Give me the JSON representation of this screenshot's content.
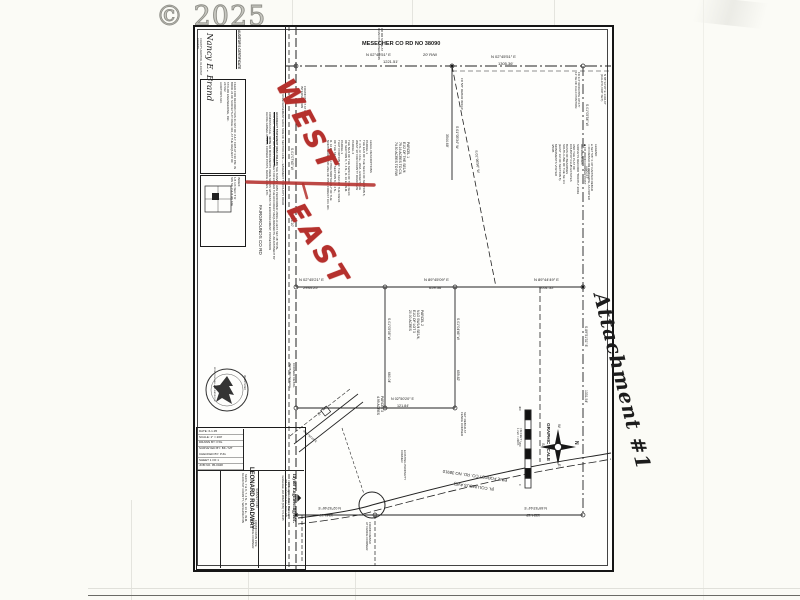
{
  "watermark": "© 2025",
  "attachment_note": "Attachment #1",
  "ink_color": "#1b1b1b",
  "red_annotations": {
    "word_top": "WEST",
    "word_bottom": "EAST",
    "color": "#b5312d"
  },
  "certificates": {
    "auditor_heading": "AUDITOR'S CERTIFICATE",
    "auditor_signature": "Nancy E. Brand",
    "auditor_signer_title": "COUNTY AUDITOR, KLICKITAT COUNTY",
    "auditor_filing": "FILED FOR RECORD THIS 21 DAY OF JULY, 1995 AT 3:30 P.M. IN BOOK 24 OF SURVEYS AT PAGE 392, AT THE REQUEST OF TAYLOR ENGINEERING, INC.\n247332\nAUDITOR'S NO.",
    "easement_note": "30' ROAD EASEMENT EACH SIDE OF SECTION LINE — EASEMENT TO COUNTY ROAD"
  },
  "index_box": {
    "text": "INDEX\n1/4 1/4   SEC    T     R\nSW SE   7 & 8   4N   16E"
  },
  "accuracy": {
    "heading": "ACCURACY STATEMENT (WAC 332-130)",
    "body": "THE SURVEY WAS PERFORMED USING A LIETZ SET-4B TOTAL STATION. TRAVERSE METHODS USED MEET OR EXCEED THE ACCURACY REQUIREMENTS. ADJUSTMENT BY COMPASS RULE.",
    "note_heading": "NOTE",
    "note": "NO MONUMENTS WERE SET AS WITNESS TO ENCROACHMENT; POSSESSION ALONG GRAVEL ROADS, CORNER POSTS, FENCE LINES, ETC."
  },
  "legal": {
    "text": "LEGAL DESCRIPTIONS\nPARCEL 1\nTHE E1/2 OF THE SE1/4 OF SECTION 8,\nT. 4 N., R. 16 E., W.M., EXCEPT THE\nWEST 30' FOR COUNTY ROAD R/W\nPARCEL 2\nTHE N1/2 OF THE SW1/4 OF THE SE1/4\nOF SECTION 8, T. 4 N., R. 16 E., W.M.\nPARCEL 3\nTHAT PORTION OF THE S1/2 OF THE SW1/4\nOF THE SE1/4 OF SECTION 8, T. 4 N.,\nR. 16 E., W.M., LYING NORTHERLY OF THE\nNORTHERLY R/W LINE OF PINE FOREST CO. RD."
  },
  "legend": {
    "text": "LEGEND\n● SET 5/8″ X 30″ CAPPED REBAR\n○ FD REBAR OR IRON PIPE, AS NOTED\n◆ FD WOOD CORNER POST\nREFERENCES\nSURVEYS RECORD \"BOOTH\" 2/049\nAND THE PLAT OF\nCOUNTRY CLUB ESTATES\nBASIS OF BEARINGS\nSOUTH LINE OF THE SE 1/4\n(EAST 1/2 OF SECTION 8)\nMONUMENTS VISITED\n4/5/95"
  },
  "parcels": {
    "p1": "PARCEL 1\nE1/2 OF THE SE1/4\n79.16 ACRES TO C/L\n74.50 ACRES TO R/W",
    "p2": "PARCEL 2\nN1/2 SW1/4 SE1/4,\nE1/2 OF LOT 3\n20.00 ACRES",
    "p3": "PARCEL 3\n4.99 ACRES"
  },
  "corner_detail": {
    "label": "CORNER DETAIL\n(NOT TO SCALE)"
  },
  "scale_bar": {
    "title": "GRAPHIC SCALE",
    "sub": "( IN FEET )\n1 inch = 200 ft."
  },
  "title_block": {
    "fields": [
      "DATE: 6-1-95",
      "SCALE: 1″ = 200′",
      "DRAWN BY: PJG",
      "SURVEYED BY: BK / MT",
      "CHECKED BY: PJG",
      "SHEET 1 OF 1",
      "JOB NO. 95-0048"
    ],
    "survey_for": "SURVEY FOR",
    "client": "LEONARD ROADWAY",
    "location": "SECS. 7 & 8, T. 4 N., R. 16 E., W.M.",
    "county": "KLICKITAT COUNTY, WASHINGTON",
    "firm": "Taylor Engineering, Inc.",
    "firm_tagline": "Civil Design and Land Planning",
    "firm_address": "205 S. Columbus Ave., Suite 200\nGoldendale, WA 98620   (509) 773-4945"
  },
  "map_labels": [
    {
      "t": "MESECHER CO RD NO 38090",
      "x": 362,
      "y": 41,
      "fs": 5.6,
      "b": true,
      "n": "road-name-top"
    },
    {
      "t": "N 02°45′51″ E",
      "x": 366,
      "y": 53,
      "fs": 4
    },
    {
      "t": "20′ R/W",
      "x": 423,
      "y": 53,
      "fs": 4
    },
    {
      "t": "1221.51′",
      "x": 383,
      "y": 60,
      "fs": 4
    },
    {
      "t": "N 02°45′51″ E",
      "x": 491,
      "y": 55,
      "fs": 4
    },
    {
      "t": "1305.36′",
      "x": 498,
      "y": 62,
      "fs": 4
    },
    {
      "t": "FOUND BOLT AT ROAD\nINTERSECTION",
      "x": 306,
      "y": 86,
      "r": 90,
      "fs": 3
    },
    {
      "t": "FD RR SPIKE AT\nROAD INTERSECTION",
      "x": 383,
      "y": 28,
      "r": 90,
      "fs": 3
    },
    {
      "t": "FD 3/4″ IRON PIPE UP 0.5′\n12′ SE OF CALC POSITION",
      "x": 580,
      "y": 72,
      "r": 90,
      "fs": 2.9
    },
    {
      "t": "N 88°12′18″ E 1304.67′\n(CALC'D, NOT SET)",
      "x": 606,
      "y": 74,
      "r": 90,
      "fs": 3
    },
    {
      "t": "FD 5/8″ REBAR W/CAP",
      "x": 463,
      "y": 78,
      "r": 90,
      "fs": 3
    },
    {
      "t": "S 01°05′34″ W",
      "x": 459,
      "y": 126,
      "r": 90,
      "fs": 3.5
    },
    {
      "t": "3544.68′",
      "x": 449,
      "y": 134,
      "r": 90,
      "fs": 3.5
    },
    {
      "t": "S 01°06′56″ W",
      "x": 478,
      "y": 150,
      "r": 84,
      "fs": 3.5
    },
    {
      "t": "FAIRGROUNDS CO RD",
      "x": 263,
      "y": 205,
      "r": 90,
      "fs": 4.6,
      "n": "road-name-left"
    },
    {
      "t": "S 01°07′43″ W",
      "x": 293,
      "y": 148,
      "r": 90,
      "fs": 3.4
    },
    {
      "t": "1324.10′",
      "x": 293,
      "y": 214,
      "r": 90,
      "fs": 3.4
    },
    {
      "t": "N 02°45′21″ E",
      "x": 299,
      "y": 278,
      "fs": 4
    },
    {
      "t": "2934.25′",
      "x": 303,
      "y": 285.5,
      "fs": 4
    },
    {
      "t": "N 89°45′09″ E",
      "x": 424,
      "y": 278,
      "fs": 4
    },
    {
      "t": "659.36′",
      "x": 429,
      "y": 285.5,
      "fs": 4
    },
    {
      "t": "N 89°44′49″ E",
      "x": 534,
      "y": 278,
      "fs": 4
    },
    {
      "t": "1051.52′",
      "x": 539,
      "y": 285.5,
      "fs": 4
    },
    {
      "t": "S 01°05′54″ W",
      "x": 588,
      "y": 104,
      "r": 90,
      "fs": 3.4
    },
    {
      "t": "1320.57′",
      "x": 588,
      "y": 166,
      "r": 90,
      "fs": 3.4
    },
    {
      "t": "S 89°51′31″ E",
      "x": 587,
      "y": 326,
      "r": 90,
      "fs": 3.4
    },
    {
      "t": "1331.54′",
      "x": 587,
      "y": 390,
      "r": 90,
      "fs": 3.4
    },
    {
      "t": "S 01°05′08″ W",
      "x": 390,
      "y": 318,
      "r": 90,
      "fs": 3.4
    },
    {
      "t": "660.04′",
      "x": 390,
      "y": 372,
      "r": 90,
      "fs": 3.4
    },
    {
      "t": "S 01°04′46″ W",
      "x": 459,
      "y": 318,
      "r": 90,
      "fs": 3.4
    },
    {
      "t": "659.82′",
      "x": 459,
      "y": 370,
      "r": 90,
      "fs": 3.4
    },
    {
      "t": "N 02°50′20″ E",
      "x": 391,
      "y": 397,
      "fs": 3.7
    },
    {
      "t": "121.84′",
      "x": 397,
      "y": 403.5,
      "fs": 3.7
    },
    {
      "t": "SET REBAR AT\nFENCE CORNER",
      "x": 466,
      "y": 412,
      "r": 90,
      "fs": 3
    },
    {
      "t": "EXISTING PROPERTY\nCORNER",
      "x": 406,
      "y": 450,
      "r": 90,
      "fs": 2.9
    },
    {
      "t": "N 02°52′46″ E",
      "x": 341,
      "y": 510,
      "r": 180,
      "fs": 3.7
    },
    {
      "t": "1341.19′",
      "x": 333,
      "y": 517,
      "r": 180,
      "fs": 3.7
    },
    {
      "t": "N 89°53′44″ E",
      "x": 547,
      "y": 510,
      "r": 180,
      "fs": 3.7
    },
    {
      "t": "1324.12′",
      "x": 540,
      "y": 517,
      "r": 180,
      "fs": 3.7
    },
    {
      "t": "PINE FOREST CO. RD. NO 38910",
      "x": 507,
      "y": 482,
      "r": 188,
      "fs": 4.2,
      "n": "road-name-bottom"
    },
    {
      "t": "(N. COLUMBUS AVE)",
      "x": 494,
      "y": 491,
      "r": 188,
      "fs": 4.2,
      "n": "road-name-bottom-alt"
    },
    {
      "t": "FOUND IRON PIPE\nAT FENCE CORNER",
      "x": 257,
      "y": 520,
      "r": 90,
      "fs": 3
    },
    {
      "t": "FOUND REBAR\nAT FENCE CORNER",
      "x": 371,
      "y": 522,
      "r": 90,
      "fs": 3
    },
    {
      "t": "30′",
      "x": 318,
      "y": 412,
      "r": 40,
      "fs": 3
    },
    {
      "t": "N 02°50′20″ E",
      "x": 304,
      "y": 430,
      "r": 40,
      "fs": 2.8
    },
    {
      "t": "N",
      "x": 578,
      "y": 441,
      "r": 90,
      "fs": 5,
      "b": true,
      "n": "compass-n"
    },
    {
      "t": "W",
      "x": 561,
      "y": 424,
      "r": 90,
      "fs": 4,
      "n": "compass-w"
    },
    {
      "t": "S",
      "x": 545,
      "y": 443,
      "r": 90,
      "fs": 4,
      "n": "compass-s"
    },
    {
      "t": "E",
      "x": 561,
      "y": 464,
      "r": 90,
      "fs": 4,
      "n": "compass-e"
    },
    {
      "t": "400",
      "x": 521,
      "y": 406,
      "r": 90,
      "fs": 2.8
    },
    {
      "t": "200",
      "x": 521,
      "y": 442,
      "r": 90,
      "fs": 2.8
    },
    {
      "t": "0",
      "x": 521,
      "y": 484,
      "r": 90,
      "fs": 2.8
    },
    {
      "t": "REGISTERED",
      "x": 245,
      "y": 375,
      "r": 90,
      "fs": 2.3,
      "n": "stamp-text"
    },
    {
      "t": "PROFESSIONAL LAND SURVEYOR",
      "x": 215,
      "y": 367,
      "r": 90,
      "fs": 2.1,
      "n": "stamp-text"
    }
  ]
}
